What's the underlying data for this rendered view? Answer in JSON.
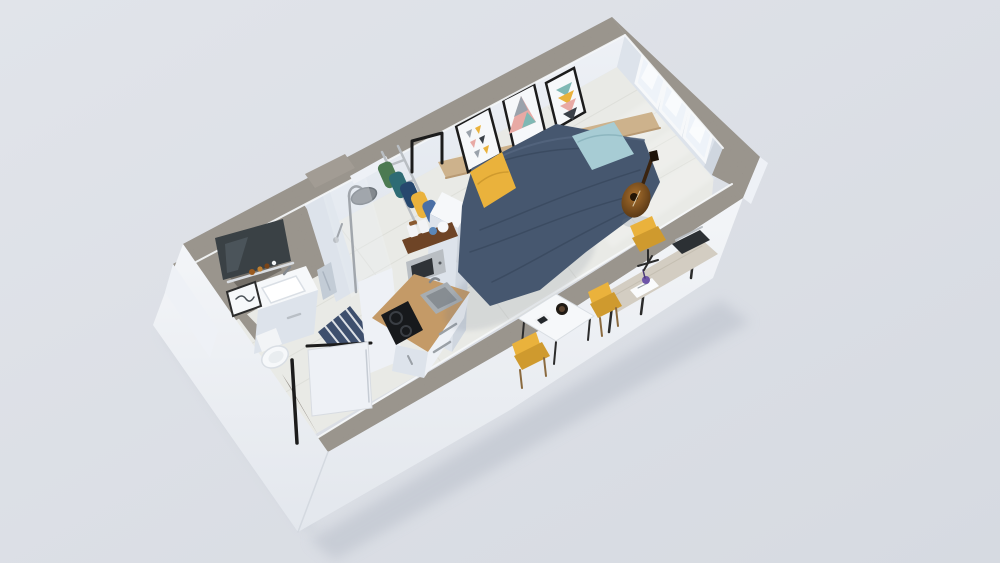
{
  "meta": {
    "title": "3D isometric cutaway render of a studio apartment floor plan",
    "view": "top-down isometric cutaway, no visible text"
  },
  "palette": {
    "bg": "#e1e4ea",
    "bgEdge": "#d6dae1",
    "wallTop": "#8e8880",
    "wallTopDark": "#746f68",
    "wallTopLight": "#a29c94",
    "wallFace": "#eef1f6",
    "wallFaceDim": "#dde3eb",
    "wallFaceDark": "#cfd6df",
    "outerTop": "#f3f5f8",
    "outerBottom": "#e3e7ed",
    "floor": "#e9eae6",
    "floorLine": "#d9dad4",
    "navy": "#46576f",
    "navyDark": "#36455a",
    "navyLight": "#55667f",
    "aqua": "#a7ccd4",
    "aquaDark": "#8db6bf",
    "yellow": "#eab23c",
    "yellowDark": "#cf9a2e",
    "woodTan": "#cdb28c",
    "woodTanDark": "#b89a74",
    "woodCounter": "#c49a67",
    "woodCounterDark": "#ad8452",
    "woodShelf": "#6e4426",
    "steel": "#b9bec3",
    "steelDark": "#84898f",
    "sinkSteel": "#a7adb2",
    "sinkInner": "#878d92",
    "cooktop": "#17191c",
    "glass": "#eef3f9",
    "mirror": "#3a4145",
    "mirrorLight": "#5a656c",
    "towel": "#c3ccd6",
    "matNavy": "#3e4f6d",
    "matStripe": "#eef0f3",
    "guitar": "#a86f2d",
    "guitarDark": "#5f3c16",
    "guitarHole": "#241505",
    "ink": "#1c1c1c",
    "white": "#f6f8fa",
    "purple": "#6e55a8",
    "laptop": "#2c3034",
    "deskTop": "#d3cdc2",
    "chairWood": "#b98d4f",
    "chairWoodDark": "#8a6a3f",
    "clothesGreen": "#4c7a52",
    "clothesTeal": "#2e6b74",
    "clothesDenim": "#27486e",
    "clothesBlue": "#4a6fa5",
    "artPink": "#e8a9a4",
    "artTeal": "#7fb8b4",
    "artGray": "#9aa2ab",
    "artDark": "#3b4148"
  },
  "rooms": [
    {
      "name": "sleeping-living-area",
      "items": [
        "double bed with navy duvet",
        "aqua pillow",
        "yellow pillow",
        "wood headboard rail",
        "three geometric art frames",
        "acoustic guitar",
        "desk with laptop and yellow chair",
        "white dining table with mug and phone",
        "two yellow chairs",
        "three windows"
      ]
    },
    {
      "name": "kitchenette",
      "items": [
        "tall white cabinet column",
        "wood countertop",
        "stainless sink",
        "black two-burner cooktop",
        "microwave",
        "wood shelf with jars and teapot",
        "drawer fronts with steel handles"
      ]
    },
    {
      "name": "shower-room",
      "items": [
        "glass shower screen",
        "rainfall shower head on pole",
        "hand shower",
        "light blue towel",
        "striped navy bath mat"
      ]
    },
    {
      "name": "bathroom",
      "items": [
        "dark mirror",
        "shelf with amber bottles",
        "white vanity with basin",
        "toilet",
        "small framed print"
      ]
    },
    {
      "name": "wardrobe-nook",
      "items": [
        "clothes rail ladder rack",
        "hanging clothes in green, teal, navy, yellow, blue",
        "black doorway trim"
      ]
    },
    {
      "name": "entry-hall",
      "items": [
        "open white entry door",
        "black door frame"
      ]
    }
  ],
  "structure": {
    "walls": "white faces with speckled gray concrete tops",
    "floor": "pale gray large tiles",
    "notch": "stepped jog in right-hand window wall",
    "niches": "two recessed service niches in the upper wall slab"
  }
}
